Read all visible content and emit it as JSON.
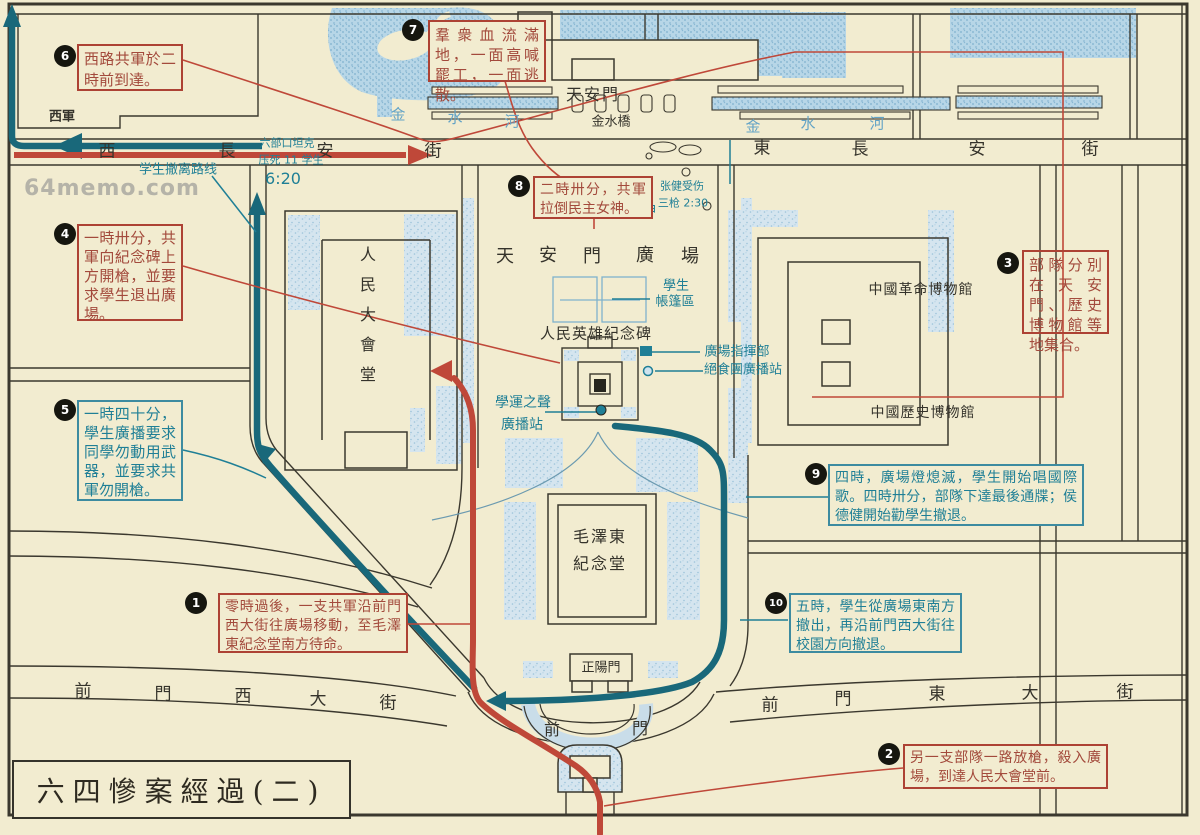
{
  "title": "六四慘案經過(二)",
  "watermark": "64memo.com",
  "colors": {
    "paper": "#f2ecd0",
    "ink": "#35332b",
    "red_route": "#bf4839",
    "teal_route": "#19687a",
    "teal_text": "#1f7f96",
    "water": "#aed2e4",
    "building_fill": "#cfe2ed",
    "blue_text": "#63a3c6",
    "watermark_gray": "#b5b3a8"
  },
  "callouts": [
    {
      "num": "1",
      "tone": "red",
      "x": 218,
      "y": 593,
      "w": 190,
      "h": 60,
      "bx": 196,
      "by": 603,
      "fs": 14,
      "lh": 19,
      "text": "零時過後，一支共軍沿前門西大街往廣場移動，至毛澤東紀念堂南方待命。"
    },
    {
      "num": "2",
      "tone": "red",
      "x": 903,
      "y": 744,
      "w": 205,
      "h": 45,
      "bx": 889,
      "by": 754,
      "fs": 14,
      "lh": 19,
      "text": "另一支部隊一路放槍，殺入廣場，到達人民大會堂前。"
    },
    {
      "num": "3",
      "tone": "red",
      "x": 1022,
      "y": 250,
      "w": 87,
      "h": 84,
      "bx": 1008,
      "by": 263,
      "fs": 15,
      "lh": 20,
      "see_through": true,
      "text": "部隊分別在天安門、歷史博物館等地集合。"
    },
    {
      "num": "4",
      "tone": "red",
      "x": 77,
      "y": 224,
      "w": 106,
      "h": 97,
      "bx": 65,
      "by": 234,
      "fs": 15,
      "lh": 19,
      "text": "一時卅分，共軍向紀念碑上方開槍，並要求學生退出廣場。"
    },
    {
      "num": "5",
      "tone": "teal",
      "x": 77,
      "y": 400,
      "w": 106,
      "h": 101,
      "bx": 65,
      "by": 410,
      "fs": 15,
      "lh": 19,
      "text": "一時四十分，學生廣播要求同學勿動用武器，並要求共軍勿開槍。"
    },
    {
      "num": "6",
      "tone": "red",
      "x": 77,
      "y": 44,
      "w": 106,
      "h": 47,
      "bx": 65,
      "by": 56,
      "fs": 15,
      "lh": 21,
      "text": "西路共軍於二時前到達。"
    },
    {
      "num": "7",
      "tone": "red",
      "x": 428,
      "y": 20,
      "w": 118,
      "h": 62,
      "bx": 413,
      "by": 30,
      "fs": 15,
      "lh": 20,
      "text": "羣衆血流滿地，一面高喊罷工，一面逃散。"
    },
    {
      "num": "8",
      "tone": "red",
      "x": 533,
      "y": 176,
      "w": 120,
      "h": 43,
      "bx": 519,
      "by": 186,
      "fs": 14,
      "lh": 19,
      "text": "二時卅分，共軍拉倒民主女神。"
    },
    {
      "num": "9",
      "tone": "teal",
      "x": 828,
      "y": 464,
      "w": 256,
      "h": 62,
      "bx": 816,
      "by": 474,
      "fs": 14,
      "lh": 19,
      "text": "四時，廣場燈熄滅，學生開始唱國際歌。四時卅分，部隊下達最後通牒；侯德健開始勸學生撤退。"
    },
    {
      "num": "10",
      "tone": "teal",
      "x": 789,
      "y": 593,
      "w": 173,
      "h": 60,
      "bx": 776,
      "by": 603,
      "fs": 14,
      "lh": 19,
      "text": "五時，學生從廣場東南方撤出，再沿前門西大街往校園方向撤退。"
    }
  ],
  "labels": [
    {
      "t": "西",
      "x": 107,
      "y": 152,
      "c": "ink",
      "s": 17,
      "n": "street-xichangan"
    },
    {
      "t": "長",
      "x": 227,
      "y": 152,
      "c": "ink",
      "s": 17,
      "n": "street-xichangan"
    },
    {
      "t": "安",
      "x": 325,
      "y": 152,
      "c": "ink",
      "s": 17,
      "n": "street-xichangan"
    },
    {
      "t": "街",
      "x": 433,
      "y": 152,
      "c": "ink",
      "s": 17,
      "n": "street-xichangan"
    },
    {
      "t": "東",
      "x": 762,
      "y": 149,
      "c": "ink",
      "s": 17,
      "n": "street-dongchangan"
    },
    {
      "t": "長",
      "x": 860,
      "y": 150,
      "c": "ink",
      "s": 17,
      "n": "street-dongchangan"
    },
    {
      "t": "安",
      "x": 977,
      "y": 150,
      "c": "ink",
      "s": 17,
      "n": "street-dongchangan"
    },
    {
      "t": "街",
      "x": 1090,
      "y": 150,
      "c": "ink",
      "s": 17,
      "n": "street-dongchangan"
    },
    {
      "t": "前",
      "x": 83,
      "y": 692,
      "c": "ink",
      "s": 17,
      "n": "street-qianmen-west"
    },
    {
      "t": "門",
      "x": 163,
      "y": 695,
      "c": "ink",
      "s": 17,
      "n": "street-qianmen-west"
    },
    {
      "t": "西",
      "x": 243,
      "y": 697,
      "c": "ink",
      "s": 17,
      "n": "street-qianmen-west"
    },
    {
      "t": "大",
      "x": 318,
      "y": 700,
      "c": "ink",
      "s": 17,
      "n": "street-qianmen-west"
    },
    {
      "t": "街",
      "x": 388,
      "y": 704,
      "c": "ink",
      "s": 17,
      "n": "street-qianmen-west"
    },
    {
      "t": "前",
      "x": 770,
      "y": 706,
      "c": "ink",
      "s": 17,
      "n": "street-qianmen-east"
    },
    {
      "t": "門",
      "x": 843,
      "y": 700,
      "c": "ink",
      "s": 17,
      "n": "street-qianmen-east"
    },
    {
      "t": "東",
      "x": 937,
      "y": 695,
      "c": "ink",
      "s": 17,
      "n": "street-qianmen-east"
    },
    {
      "t": "大",
      "x": 1030,
      "y": 694,
      "c": "ink",
      "s": 17,
      "n": "street-qianmen-east"
    },
    {
      "t": "街",
      "x": 1125,
      "y": 693,
      "c": "ink",
      "s": 17,
      "n": "street-qianmen-east"
    },
    {
      "t": "西軍",
      "x": 62,
      "y": 117,
      "c": "ink",
      "s": 13,
      "b": 1,
      "n": "label-west-army"
    },
    {
      "t": "天安門",
      "x": 593,
      "y": 95,
      "c": "ink",
      "s": 16,
      "ls": 2,
      "n": "label-tiananmen-gate"
    },
    {
      "t": "金水橋",
      "x": 611,
      "y": 122,
      "c": "ink",
      "s": 13,
      "n": "label-golden-water-bridge"
    },
    {
      "t": "金",
      "x": 398,
      "y": 115,
      "c": "blue",
      "s": 15,
      "n": "label-golden-water-river"
    },
    {
      "t": "水",
      "x": 455,
      "y": 118,
      "c": "blue",
      "s": 15,
      "n": "label-golden-water-river"
    },
    {
      "t": "河",
      "x": 512,
      "y": 122,
      "c": "blue",
      "s": 15,
      "n": "label-golden-water-river"
    },
    {
      "t": "金",
      "x": 753,
      "y": 127,
      "c": "blue",
      "s": 15,
      "n": "label-golden-water-river"
    },
    {
      "t": "水",
      "x": 808,
      "y": 124,
      "c": "blue",
      "s": 15,
      "n": "label-golden-water-river"
    },
    {
      "t": "河",
      "x": 877,
      "y": 124,
      "c": "blue",
      "s": 15,
      "n": "label-golden-water-river"
    },
    {
      "t": "天",
      "x": 505,
      "y": 257,
      "c": "ink",
      "s": 18,
      "n": "label-tiananmen-square"
    },
    {
      "t": "安",
      "x": 548,
      "y": 256,
      "c": "ink",
      "s": 18,
      "n": "label-tiananmen-square"
    },
    {
      "t": "門",
      "x": 592,
      "y": 257,
      "c": "ink",
      "s": 18,
      "n": "label-tiananmen-square"
    },
    {
      "t": "廣",
      "x": 645,
      "y": 256,
      "c": "ink",
      "s": 18,
      "n": "label-tiananmen-square"
    },
    {
      "t": "場",
      "x": 690,
      "y": 257,
      "c": "ink",
      "s": 18,
      "n": "label-tiananmen-square"
    },
    {
      "t": "人民英雄紀念碑",
      "x": 596,
      "y": 334,
      "c": "ink",
      "s": 15,
      "ls": 1,
      "n": "label-monument"
    },
    {
      "t": "中國革命博物館",
      "x": 921,
      "y": 290,
      "c": "ink",
      "s": 14,
      "ls": 1,
      "n": "label-revolution-museum"
    },
    {
      "t": "中國歷史博物館",
      "x": 923,
      "y": 413,
      "c": "ink",
      "s": 14,
      "ls": 1,
      "n": "label-history-museum"
    },
    {
      "t": "人",
      "x": 368,
      "y": 255,
      "c": "ink",
      "s": 16,
      "n": "label-great-hall"
    },
    {
      "t": "民",
      "x": 368,
      "y": 285,
      "c": "ink",
      "s": 16,
      "n": "label-great-hall"
    },
    {
      "t": "大",
      "x": 368,
      "y": 315,
      "c": "ink",
      "s": 16,
      "n": "label-great-hall"
    },
    {
      "t": "會",
      "x": 368,
      "y": 345,
      "c": "ink",
      "s": 16,
      "n": "label-great-hall"
    },
    {
      "t": "堂",
      "x": 368,
      "y": 375,
      "c": "ink",
      "s": 16,
      "n": "label-great-hall"
    },
    {
      "t": "毛澤東",
      "x": 600,
      "y": 537,
      "c": "ink",
      "s": 16,
      "ls": 2,
      "n": "label-mao-mausoleum"
    },
    {
      "t": "紀念堂",
      "x": 600,
      "y": 564,
      "c": "ink",
      "s": 16,
      "ls": 2,
      "n": "label-mao-mausoleum"
    },
    {
      "t": "正陽門",
      "x": 601,
      "y": 668,
      "c": "ink",
      "s": 13,
      "n": "label-zhengyangmen"
    },
    {
      "t": "前",
      "x": 552,
      "y": 730,
      "c": "ink",
      "s": 16,
      "n": "label-qianmen"
    },
    {
      "t": "門",
      "x": 640,
      "y": 729,
      "c": "ink",
      "s": 16,
      "n": "label-qianmen"
    },
    {
      "t": "学生撤离路线",
      "x": 178,
      "y": 170,
      "c": "teal",
      "s": 13,
      "n": "label-student-retreat-route"
    },
    {
      "t": "六部口坦克",
      "x": 287,
      "y": 143,
      "c": "teal",
      "s": 11,
      "n": "label-liubukou-tank"
    },
    {
      "t": "压死 11 学生",
      "x": 291,
      "y": 160,
      "c": "teal",
      "s": 11,
      "n": "label-crushed-students"
    },
    {
      "t": "6:20",
      "x": 283,
      "y": 179,
      "c": "teal",
      "s": 16,
      "n": "label-time-620"
    },
    {
      "t": "张健受伤",
      "x": 682,
      "y": 186,
      "c": "teal",
      "s": 11,
      "n": "label-zhangjian-wounded"
    },
    {
      "t": "三枪 2:30",
      "x": 683,
      "y": 203,
      "c": "teal",
      "s": 11,
      "n": "label-three-shots"
    },
    {
      "t": "民主女神",
      "x": 628,
      "y": 211,
      "c": "teal",
      "s": 14,
      "n": "label-goddess-of-democracy"
    },
    {
      "t": "學生",
      "x": 676,
      "y": 286,
      "c": "teal",
      "s": 13,
      "n": "label-tent-area"
    },
    {
      "t": "帳篷區",
      "x": 675,
      "y": 302,
      "c": "teal",
      "s": 13,
      "n": "label-tent-area"
    },
    {
      "t": "廣場指揮部",
      "x": 737,
      "y": 352,
      "c": "teal",
      "s": 13,
      "n": "label-square-command"
    },
    {
      "t": "絕食團廣播站",
      "x": 743,
      "y": 370,
      "c": "teal",
      "s": 13,
      "n": "label-hunger-strike-broadcast"
    },
    {
      "t": "學運之聲",
      "x": 523,
      "y": 403,
      "c": "teal",
      "s": 14,
      "n": "label-voice-of-student-movement"
    },
    {
      "t": "廣播站",
      "x": 522,
      "y": 425,
      "c": "teal",
      "s": 14,
      "n": "label-voice-of-student-movement"
    }
  ]
}
